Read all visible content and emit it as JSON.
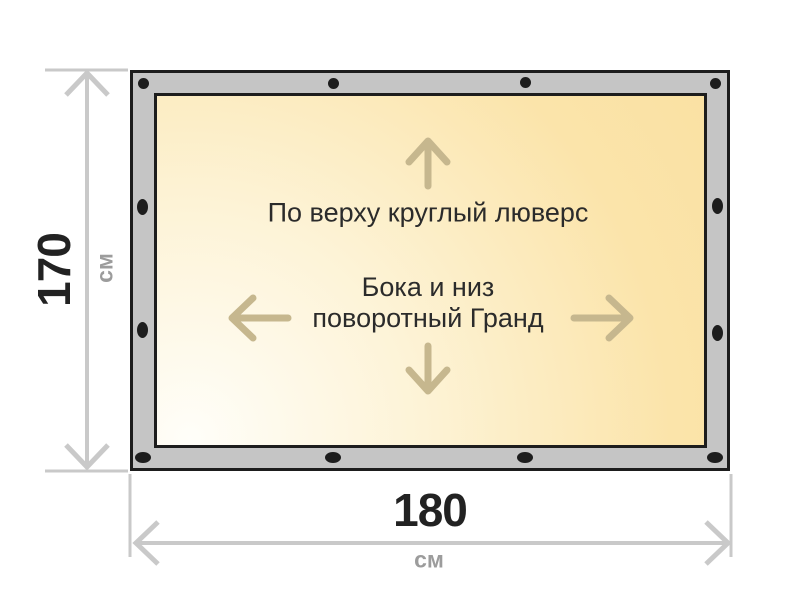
{
  "banner": {
    "label_top_grommet": "По верху круглый люверс",
    "label_sides_line1": "Бока и низ",
    "label_sides_line2": "поворотный Гранд"
  },
  "dimensions": {
    "height": {
      "value": "170",
      "unit": "см"
    },
    "width": {
      "value": "180",
      "unit": "см"
    }
  },
  "colors": {
    "frame_fill": "#c5c5c5",
    "outline": "#1d1d1d",
    "grommet": "#1d1d1d",
    "fabric_light": "#fffef9",
    "fabric_dark": "#fae1a3",
    "dimension_line": "#c9c9c9",
    "dimension_value_text": "#222222",
    "dimension_unit_text": "#9c9c9c",
    "direction_arrow": "#c6b78e",
    "label_text": "#2b2b2b"
  },
  "icons": {
    "grommet": "small dark dot/oval on frame edge",
    "up_arrow": "↑",
    "down_arrow": "↓",
    "left_arrow": "←",
    "right_arrow": "→",
    "dimension_arrow": "double-headed chevron measure line"
  }
}
